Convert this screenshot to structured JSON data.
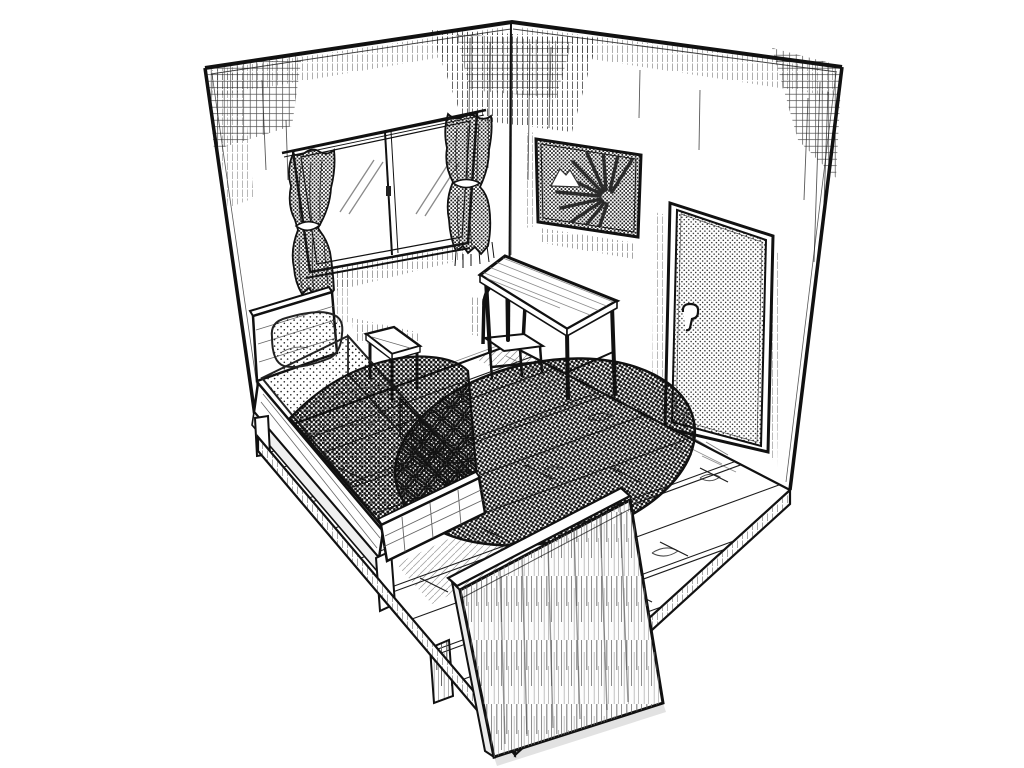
{
  "illustration": {
    "style": "manga ink line art, black and white with halftone screentones",
    "description": "Isometric cutaway drawing of a small bedroom: bed with pillow and dark halftone blanket along the left wall, small nightstand, sliding window with tied-back patterned curtains, sunburst poster and dotted door on the right wall, desk with arch-backed chair, large round halftone rug, wooden plank floor cut away at the front, and a tall wood-grain panel in the foreground",
    "palette": {
      "ink": "#1a1a1a",
      "paper": "#ffffff",
      "halftone_dark": "#8f8f8f",
      "halftone_mid": "#b5b5b5",
      "halftone_light": "#e2e2e2"
    },
    "objects": [
      {
        "name": "bed",
        "parts": [
          "headboard",
          "pillow",
          "sheet",
          "blanket",
          "side-rail",
          "footboard"
        ]
      },
      {
        "name": "nightstand"
      },
      {
        "name": "sliding-window",
        "parts": [
          "curtain-rod",
          "curtain-left",
          "curtain-right",
          "glass-panes",
          "center-latch"
        ]
      },
      {
        "name": "sunburst-poster"
      },
      {
        "name": "door",
        "parts": [
          "door-frame",
          "lever-handle"
        ]
      },
      {
        "name": "desk"
      },
      {
        "name": "desk-chair"
      },
      {
        "name": "round-rug"
      },
      {
        "name": "wood-plank-floor"
      },
      {
        "name": "foreground-wood-panel"
      }
    ]
  }
}
